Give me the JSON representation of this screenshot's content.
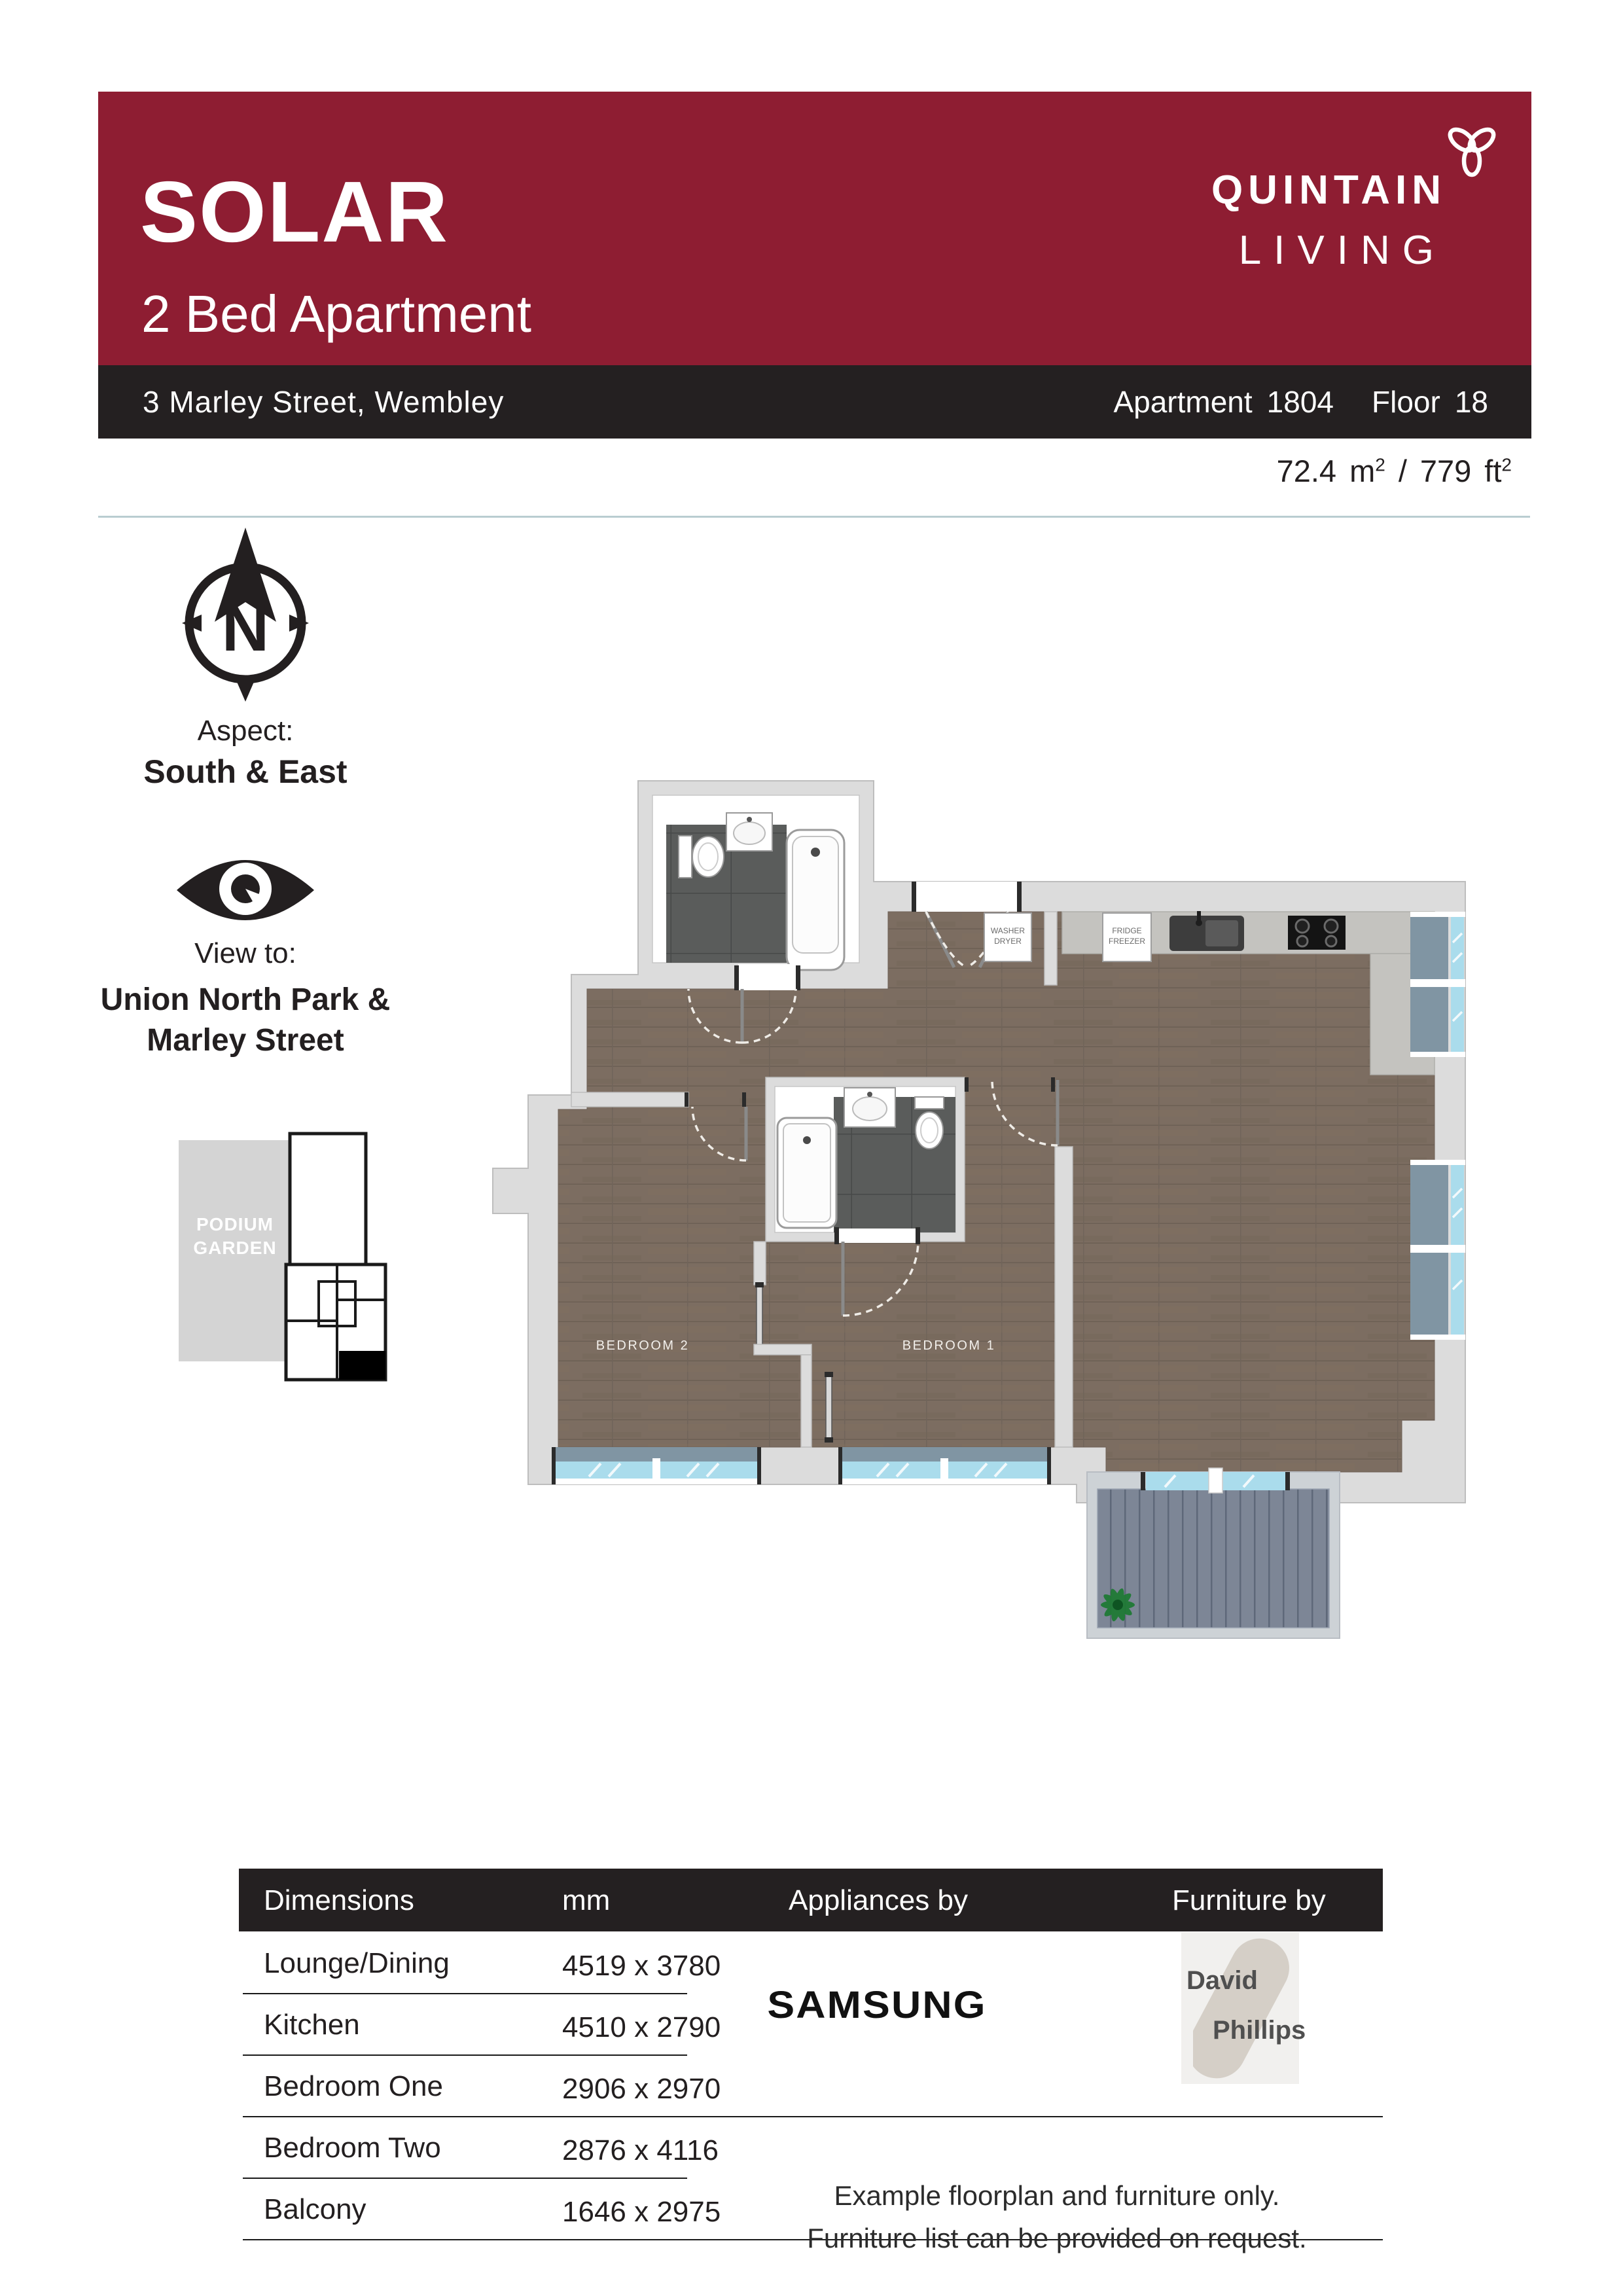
{
  "header": {
    "development": "SOLAR",
    "subtitle": "2 Bed Apartment",
    "brand_line1": "QUINTAIN",
    "brand_line2": "LIVING",
    "address": "3 Marley Street, Wembley",
    "apartment_label": "Apartment",
    "apartment_number": "1804",
    "floor_label": "Floor",
    "floor_number": "18",
    "area_metric_value": "72.4",
    "area_metric_unit": "m",
    "area_separator": "/",
    "area_imperial_value": "779",
    "area_imperial_unit": "ft",
    "area_sup": "2"
  },
  "aspect": {
    "compass_letter": "N",
    "label": "Aspect:",
    "value": "South & East"
  },
  "view": {
    "label": "View to:",
    "value_line1": "Union North Park &",
    "value_line2": "Marley Street"
  },
  "minimap": {
    "garden_line1": "PODIUM",
    "garden_line2": "GARDEN"
  },
  "floorplan": {
    "bedroom1_label": "BEDROOM 1",
    "bedroom2_label": "BEDROOM 2",
    "washer_line1": "WASHER",
    "washer_line2": "DRYER",
    "fridge_line1": "FRIDGE",
    "fridge_line2": "FREEZER"
  },
  "table": {
    "header_dimensions": "Dimensions",
    "header_mm": "mm",
    "header_appliances": "Appliances by",
    "header_furniture": "Furniture by",
    "rows": [
      {
        "label": "Lounge/Dining",
        "value": "4519 x 3780"
      },
      {
        "label": "Kitchen",
        "value": "4510 x 2790"
      },
      {
        "label": "Bedroom One",
        "value": "2906 x 2970"
      },
      {
        "label": "Bedroom Two",
        "value": "2876 x 4116"
      },
      {
        "label": "Balcony",
        "value": "1646 x 2975"
      }
    ],
    "appliances_brand": "SAMSUNG",
    "furniture_brand_line1": "David",
    "furniture_brand_line2": "Phillips",
    "disclaimer_line1": "Example floorplan and furniture only.",
    "disclaimer_line2": "Furniture list can be provided on request."
  },
  "colors": {
    "brand_maroon": "#8E1D32",
    "bar_black": "#242021",
    "separator": "#B9CDD1",
    "window_blue": "#AADCEC",
    "sill_gray_blue": "#8095A3",
    "wood_floor": "#7C6D61",
    "wall_gray": "#DCDCDC",
    "deck_gray": "#7D8696"
  }
}
